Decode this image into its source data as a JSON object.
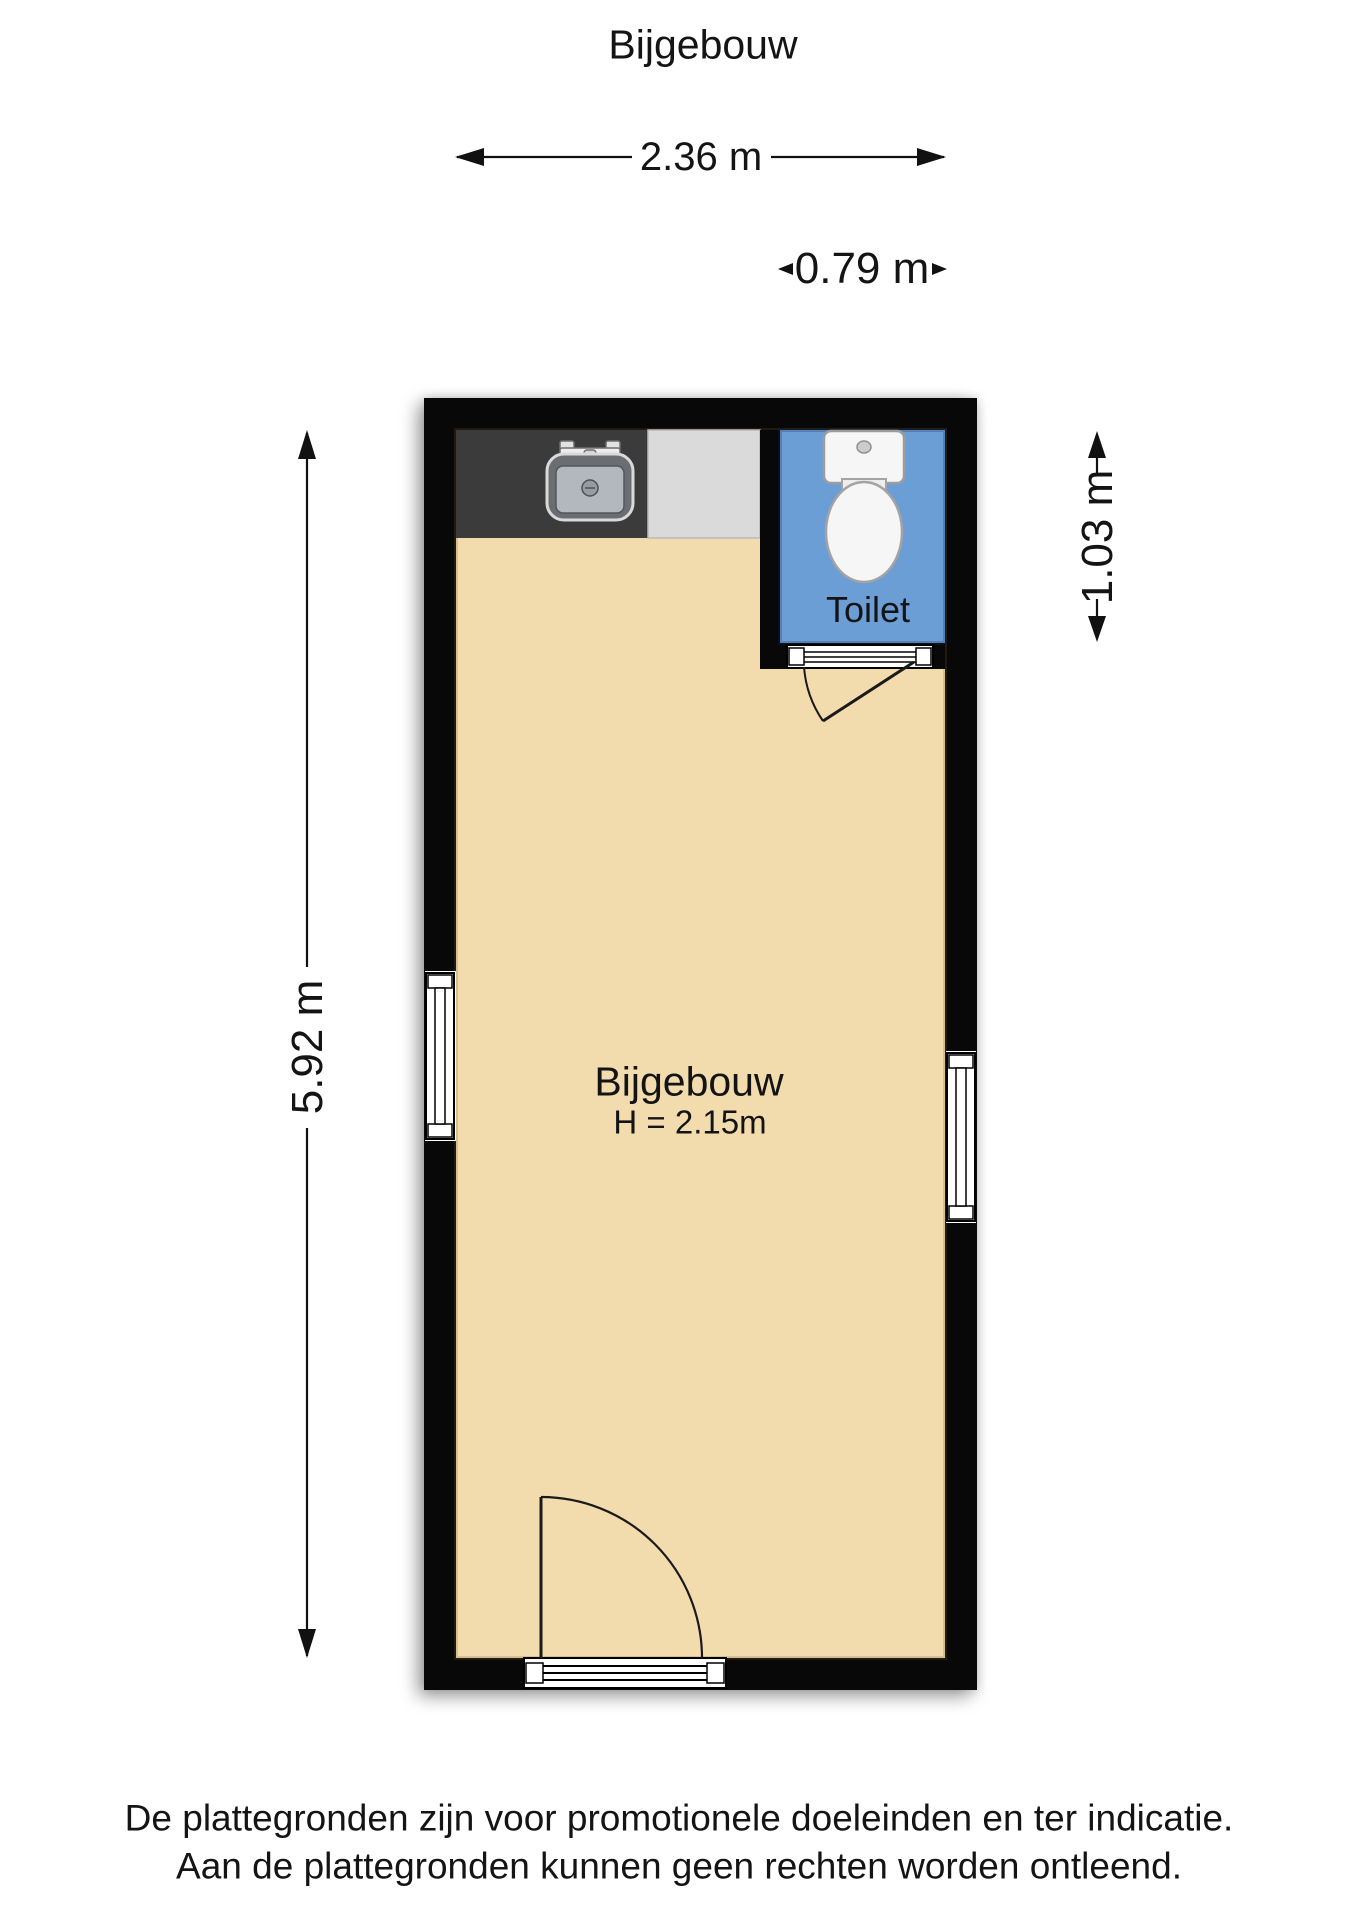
{
  "title": "Bijgebouw",
  "dimensions": {
    "width": "2.36 m",
    "toilet_width": "0.79 m",
    "height": "5.92 m",
    "toilet_height": "1.03 m"
  },
  "rooms": {
    "main": {
      "name": "Bijgebouw",
      "ceiling_height": "H = 2.15m"
    },
    "toilet": {
      "name": "Toilet"
    }
  },
  "footer": {
    "line1": "De plattegronden zijn voor promotionele doeleinden en ter indicatie.",
    "line2": "Aan de plattegronden kunnen geen rechten worden ontleend."
  },
  "colors": {
    "wall": "#080808",
    "floor": "#F2DCAE",
    "toilet_floor": "#6C9ED6",
    "counter_dark": "#3B3B3B",
    "counter_light": "#DADADA",
    "fixture": "#F6F6F6",
    "line": "#111111"
  }
}
